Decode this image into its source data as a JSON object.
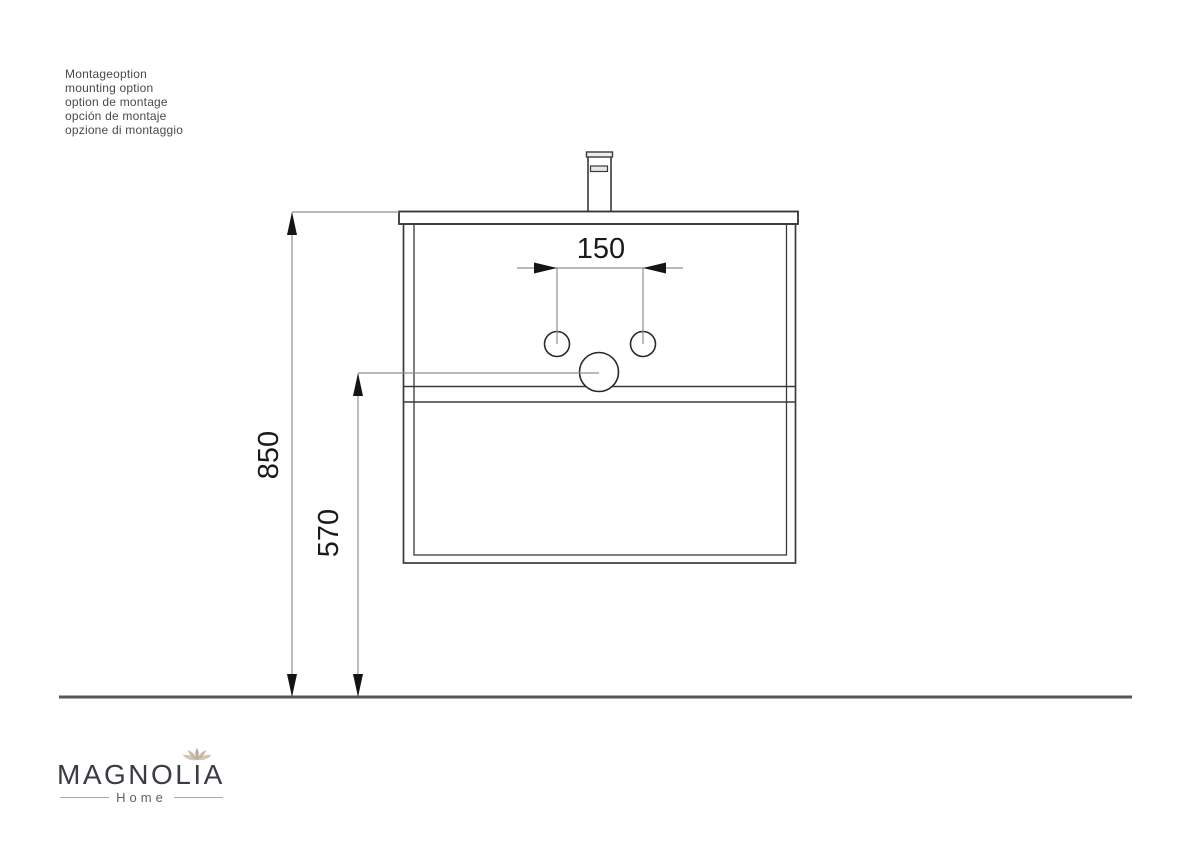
{
  "annotation": {
    "lines": [
      "Montageoption",
      "mounting option",
      "option de montage",
      "opción de montaje",
      "opzione di montaggio"
    ]
  },
  "dimensions": {
    "hole_spacing": "150",
    "total_height": "850",
    "drain_height": "570"
  },
  "logo": {
    "brand": "MAGNOLIA",
    "subtitle": "Home"
  },
  "colors": {
    "drawing_line": "#3a3a3a",
    "dimension_line": "#8f8f8f",
    "arrow_fill": "#141414",
    "floor_line": "#565656",
    "flower_gold": "#b9a98e",
    "logo_text": "#3b3b44",
    "background": "#ffffff"
  }
}
